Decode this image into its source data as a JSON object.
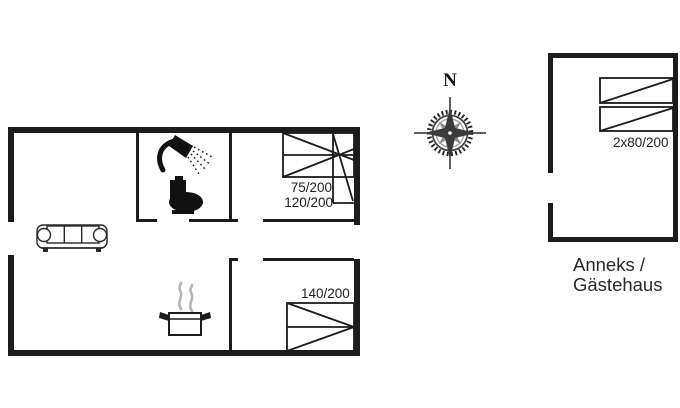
{
  "drawing": {
    "background": "#ffffff",
    "line_color": "#1c1c1c",
    "steam_color": "#b4b4b4",
    "compass": {
      "north_label": "N"
    },
    "beds": [
      {
        "room": "main-house-bedroom-top",
        "label": "75/200"
      },
      {
        "room": "main-house-bedroom-top",
        "label": "120/200"
      },
      {
        "room": "main-house-bedroom-bottom",
        "label": "140/200"
      },
      {
        "room": "annex",
        "label": "2x80/200"
      }
    ],
    "annex_caption": {
      "line1": "Anneks /",
      "line2": "Gästehaus"
    },
    "icons": {
      "sofa-icon": "three-seat sofa outline",
      "shower-icon": "handheld shower head with spray",
      "toilet-icon": "toilet silhouette",
      "cooking-pot-icon": "steaming cooking pot",
      "compass-rose-icon": "eight-point compass rose"
    }
  }
}
